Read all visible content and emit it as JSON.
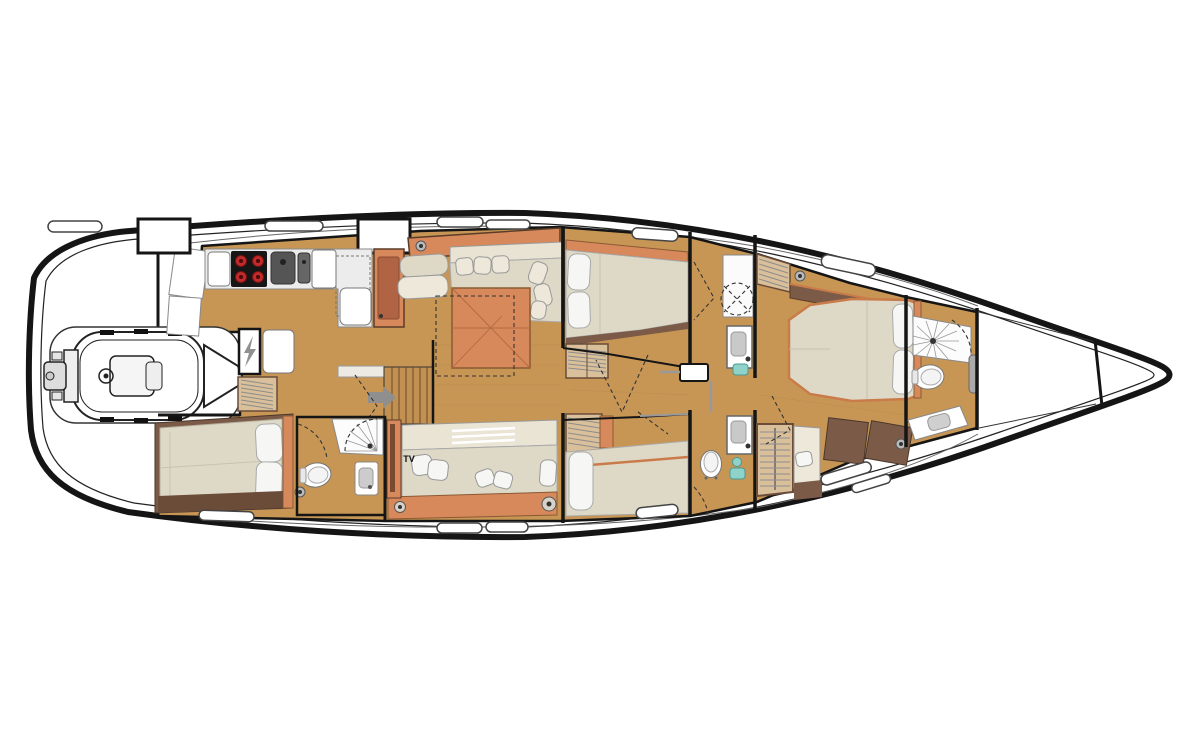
{
  "scene": {
    "title": "Sailing yacht interior layout plan",
    "orientation": {
      "bow": "right",
      "stern": "left"
    }
  },
  "labels": {
    "tv": "TV"
  },
  "colors": {
    "floor": "#C79655",
    "floorDark": "#B8873F",
    "wood": "#D8895B",
    "woodDark": "#B06443",
    "uph": "#DED9C7",
    "uphLight": "#EDE8DA",
    "pillow": "#F6F6F4",
    "trim": "#7B5B48",
    "trimDark": "#6B4C39",
    "locker": "#D9C09A",
    "counter": "#EFEFEF",
    "appliance": "#161616",
    "burner": "#C22B2B",
    "teal": "#8FD2CA",
    "arrow": "#8F8F8F",
    "wall": "#151515",
    "line": "#333333"
  },
  "features": [
    "hull",
    "tender-garage",
    "tender-dinghy",
    "cockpit-seats",
    "galley",
    "cooktop",
    "galley-sinks",
    "nav-cabinet",
    "electrical-panel",
    "companionway-stairs",
    "entry-arrow",
    "saloon-l-sofa",
    "saloon-table",
    "saloon-sofa",
    "tv-cabinet",
    "aft-cabin-double-bed",
    "aft-head-shower",
    "aft-head-toilet",
    "aft-head-sink",
    "mid-cabin-port-bed",
    "mid-head-port-shower",
    "mid-head-port-sink",
    "mid-cabin-stbd-bed",
    "mid-head-stbd-toilet",
    "mid-head-stbd-sink",
    "hanging-lockers",
    "owner-cabin-island-bed",
    "owner-head-shower",
    "owner-head-toilet",
    "owner-vanity",
    "forepeak-sail-locker",
    "deck-hatches"
  ]
}
